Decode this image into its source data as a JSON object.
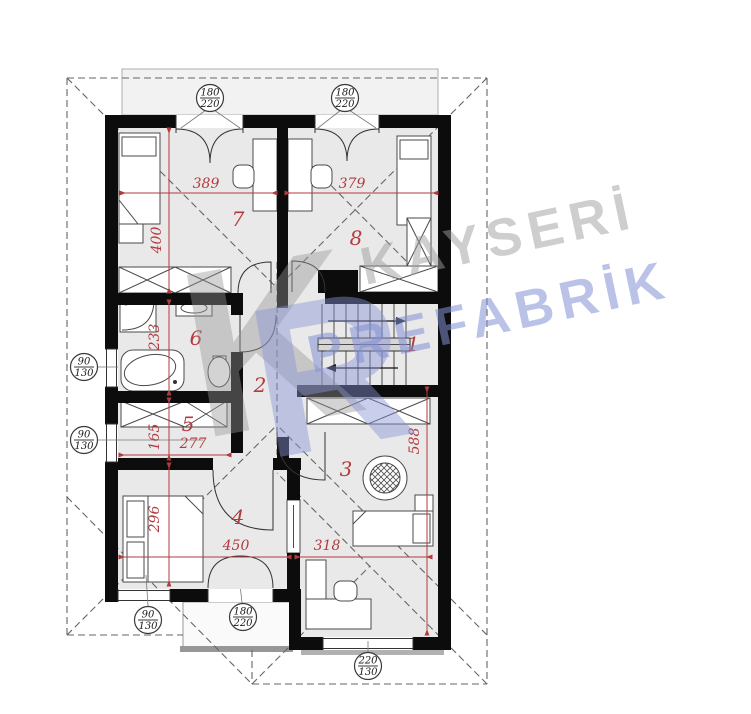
{
  "colors": {
    "wall": "#0c0c0c",
    "room_fill": "#e9e9e9",
    "terrace_fill": "#f2f2f2",
    "dim_red": "#b23b3e",
    "roof_dash": "#666666",
    "furniture_stroke": "#4a4a4a",
    "watermark_gray": "rgba(158,158,158,0.5)",
    "watermark_blue": "rgba(132,144,211,0.55)"
  },
  "rooms": [
    {
      "label": "1"
    },
    {
      "label": "2"
    },
    {
      "label": "3"
    },
    {
      "label": "4"
    },
    {
      "label": "5"
    },
    {
      "label": "6"
    },
    {
      "label": "7"
    },
    {
      "label": "8"
    }
  ],
  "dims": {
    "room7_width": "389",
    "room8_width": "379",
    "room7_height": "400",
    "bath_height": "233",
    "room5_height": "165",
    "room5_width": "277",
    "room4_height": "296",
    "room4_width": "450",
    "room3_width": "318",
    "room3_height": "588"
  },
  "tags": [
    {
      "top": "180",
      "bottom": "220"
    },
    {
      "top": "180",
      "bottom": "220"
    },
    {
      "top": "90",
      "bottom": "130"
    },
    {
      "top": "90",
      "bottom": "130"
    },
    {
      "top": "90",
      "bottom": "130"
    },
    {
      "top": "180",
      "bottom": "220"
    },
    {
      "top": "220",
      "bottom": "130"
    }
  ],
  "watermark": {
    "line1": "KAYSERİ",
    "line2": "PREFABRİK",
    "monogram_left": "K",
    "monogram_right": "R"
  }
}
